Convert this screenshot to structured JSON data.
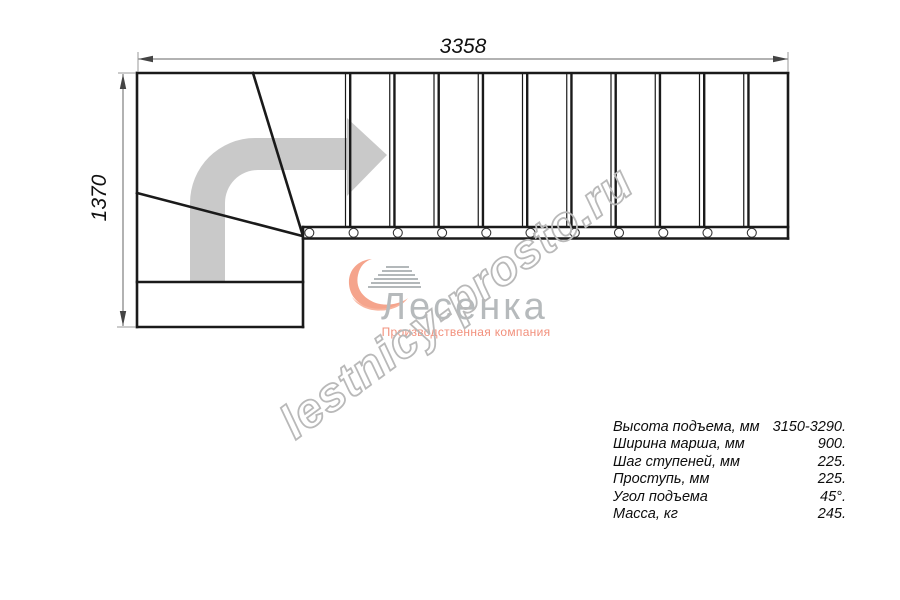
{
  "drawing": {
    "dim_width_label": "3358",
    "dim_height_label": "1370"
  },
  "plan": {
    "straight_steps": 10,
    "balusters": 11,
    "winder_steps": 3
  },
  "logo": {
    "brand": "Лесенка",
    "tagline": "Производственная компания"
  },
  "watermark": "lestnicy-prosto.ru",
  "specs": {
    "rows": [
      {
        "label": "Высота подъема, мм",
        "value": "3150-3290."
      },
      {
        "label": "Ширина марша, мм",
        "value": "900."
      },
      {
        "label": "Шаг ступеней, мм",
        "value": "225."
      },
      {
        "label": "Проступь, мм",
        "value": "225."
      },
      {
        "label": "Угол подъема",
        "value": "45°."
      },
      {
        "label": "Масса, кг",
        "value": "245."
      }
    ]
  },
  "colors": {
    "line": "#1a1a1a",
    "dimension": "#666666",
    "direction_arrow": "#c9c9c9",
    "logo_accent": "#f5a48c",
    "logo_text": "#b6babc",
    "watermark": "#b9b9b9"
  }
}
